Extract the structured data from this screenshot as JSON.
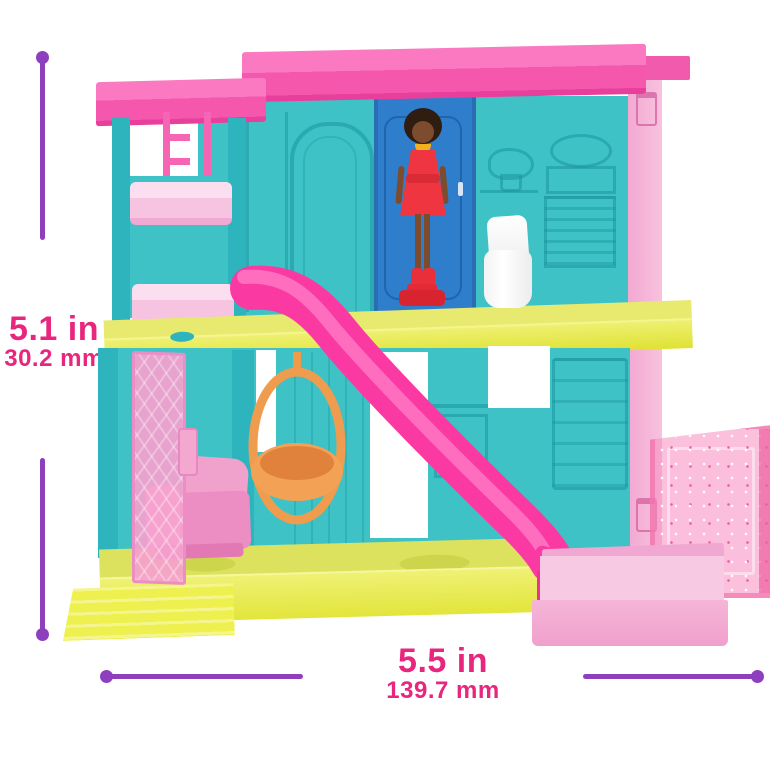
{
  "annotations": {
    "height": {
      "primary": "5.1 in",
      "secondary": "30.2 mm"
    },
    "width": {
      "primary": "5.5 in",
      "secondary": "139.7 mm"
    }
  },
  "colors": {
    "label_text": "#e9267d",
    "dimension_line": "#8e3fbe",
    "roof_pink": "#f857ac",
    "wall_teal": "#3fc2c5",
    "door_blue": "#2e7ecb",
    "floor_yellow": "#e6e845",
    "slide_pink": "#fa3aa2",
    "swing_orange": "#f09b4a",
    "exterior_wall_pink": "#f6b6d9",
    "pool_pink": "#f3abd4",
    "doll_dress_red": "#ee3540"
  }
}
